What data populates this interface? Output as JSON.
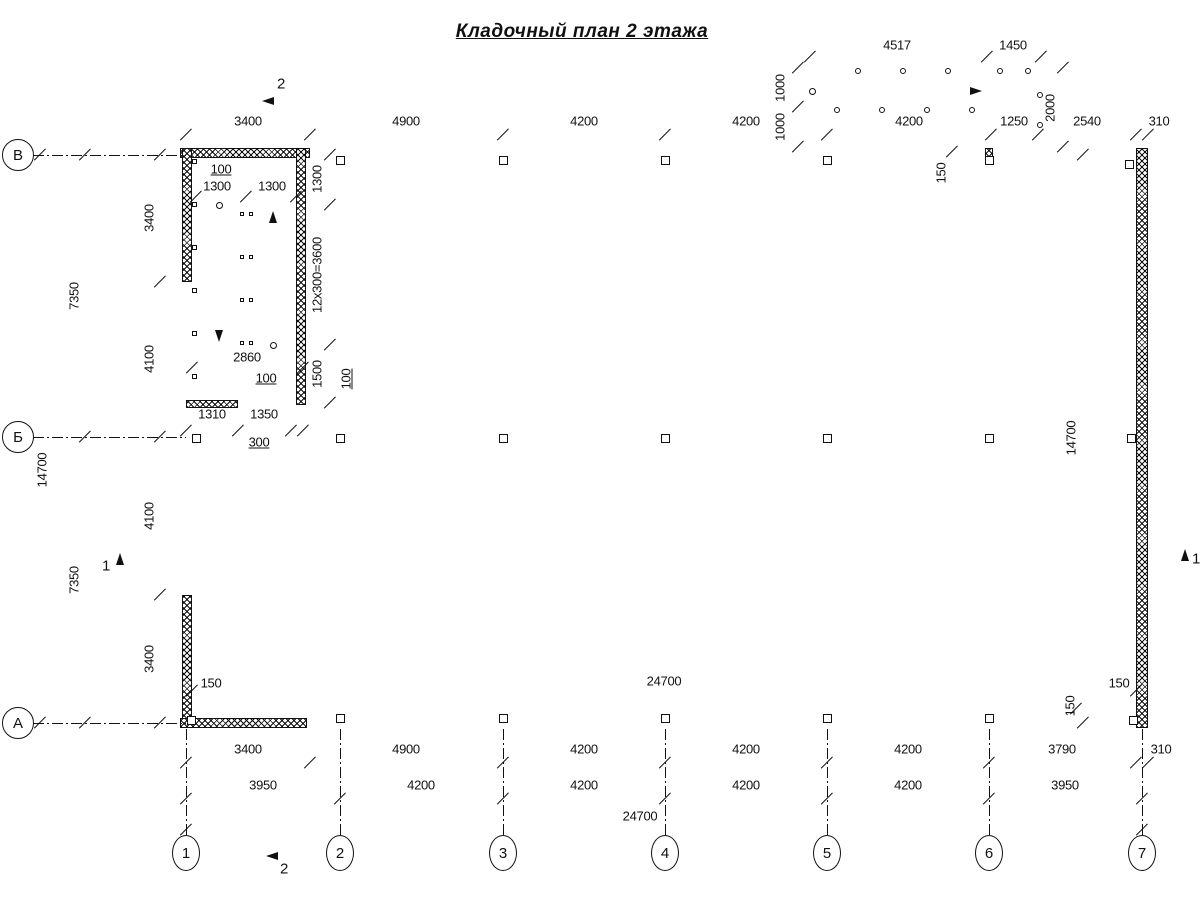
{
  "title": "Кладочный план 2 этажа",
  "drawing": {
    "axis_left": [
      {
        "t": "В",
        "x": 18,
        "y": 155
      },
      {
        "t": "Б",
        "x": 18,
        "y": 437
      },
      {
        "t": "А",
        "x": 18,
        "y": 723
      }
    ],
    "axis_bottom": [
      {
        "t": "1",
        "x": 186,
        "y": 853
      },
      {
        "t": "2",
        "x": 340,
        "y": 853
      },
      {
        "t": "3",
        "x": 503,
        "y": 853
      },
      {
        "t": "4",
        "x": 665,
        "y": 853
      },
      {
        "t": "5",
        "x": 827,
        "y": 853
      },
      {
        "t": "6",
        "x": 989,
        "y": 853
      },
      {
        "t": "7",
        "x": 1142,
        "y": 853
      }
    ],
    "section_labels": [
      {
        "t": "2",
        "x": 281,
        "y": 84
      },
      {
        "t": "2",
        "x": 284,
        "y": 869
      },
      {
        "t": "1",
        "x": 106,
        "y": 566
      },
      {
        "t": "1",
        "x": 1196,
        "y": 559
      }
    ],
    "dim_labels": [
      {
        "t": "4517",
        "x": 897,
        "y": 45
      },
      {
        "t": "1450",
        "x": 1013,
        "y": 45
      },
      {
        "t": "1000",
        "x": 780,
        "y": 88,
        "r": 1
      },
      {
        "t": "1000",
        "x": 780,
        "y": 127,
        "r": 1
      },
      {
        "t": "2000",
        "x": 1050,
        "y": 108,
        "r": 1
      },
      {
        "t": "3400",
        "x": 248,
        "y": 121
      },
      {
        "t": "4900",
        "x": 406,
        "y": 121
      },
      {
        "t": "4200",
        "x": 584,
        "y": 121
      },
      {
        "t": "4200",
        "x": 746,
        "y": 121
      },
      {
        "t": "4200",
        "x": 909,
        "y": 121
      },
      {
        "t": "1250",
        "x": 1014,
        "y": 121
      },
      {
        "t": "2540",
        "x": 1087,
        "y": 121
      },
      {
        "t": "310",
        "x": 1159,
        "y": 121
      },
      {
        "t": "150",
        "x": 941,
        "y": 173,
        "r": 1
      },
      {
        "t": "3400",
        "x": 149,
        "y": 218,
        "r": 1
      },
      {
        "t": "4100",
        "x": 149,
        "y": 359,
        "r": 1
      },
      {
        "t": "4100",
        "x": 149,
        "y": 516,
        "r": 1
      },
      {
        "t": "3400",
        "x": 149,
        "y": 659,
        "r": 1
      },
      {
        "t": "7350",
        "x": 74,
        "y": 296,
        "r": 1
      },
      {
        "t": "7350",
        "x": 74,
        "y": 580,
        "r": 1
      },
      {
        "t": "14700",
        "x": 42,
        "y": 470,
        "r": 1
      },
      {
        "t": "100",
        "x": 221,
        "y": 169,
        "u": 1
      },
      {
        "t": "1300",
        "x": 217,
        "y": 186
      },
      {
        "t": "1300",
        "x": 272,
        "y": 186
      },
      {
        "t": "1300",
        "x": 317,
        "y": 179,
        "r": 1
      },
      {
        "t": "12x300=3600",
        "x": 317,
        "y": 275,
        "r": 1
      },
      {
        "t": "1500",
        "x": 317,
        "y": 374,
        "r": 1
      },
      {
        "t": "100",
        "x": 346,
        "y": 379,
        "r": 1,
        "u": 1
      },
      {
        "t": "2860",
        "x": 247,
        "y": 357
      },
      {
        "t": "100",
        "x": 266,
        "y": 378,
        "u": 1
      },
      {
        "t": "1310",
        "x": 212,
        "y": 414
      },
      {
        "t": "1350",
        "x": 264,
        "y": 414
      },
      {
        "t": "300",
        "x": 259,
        "y": 442,
        "u": 1
      },
      {
        "t": "24700",
        "x": 664,
        "y": 681
      },
      {
        "t": "150",
        "x": 211,
        "y": 683
      },
      {
        "t": "150",
        "x": 1119,
        "y": 683
      },
      {
        "t": "150",
        "x": 1070,
        "y": 706,
        "r": 1
      },
      {
        "t": "14700",
        "x": 1071,
        "y": 438,
        "r": 1
      },
      {
        "t": "3400",
        "x": 248,
        "y": 749
      },
      {
        "t": "4900",
        "x": 406,
        "y": 749
      },
      {
        "t": "4200",
        "x": 584,
        "y": 749
      },
      {
        "t": "4200",
        "x": 746,
        "y": 749
      },
      {
        "t": "4200",
        "x": 908,
        "y": 749
      },
      {
        "t": "3790",
        "x": 1062,
        "y": 749
      },
      {
        "t": "310",
        "x": 1161,
        "y": 749
      },
      {
        "t": "3950",
        "x": 263,
        "y": 785
      },
      {
        "t": "4200",
        "x": 421,
        "y": 785
      },
      {
        "t": "4200",
        "x": 584,
        "y": 785
      },
      {
        "t": "4200",
        "x": 746,
        "y": 785
      },
      {
        "t": "4200",
        "x": 908,
        "y": 785
      },
      {
        "t": "3950",
        "x": 1065,
        "y": 785
      },
      {
        "t": "24700",
        "x": 640,
        "y": 816
      }
    ],
    "walls": [
      {
        "x": 180,
        "y": 148,
        "w": 130,
        "h": 10
      },
      {
        "x": 182,
        "y": 148,
        "w": 10,
        "h": 134
      },
      {
        "x": 182,
        "y": 595,
        "w": 10,
        "h": 133
      },
      {
        "x": 180,
        "y": 718,
        "w": 127,
        "h": 10
      },
      {
        "x": 1136,
        "y": 148,
        "w": 12,
        "h": 580
      },
      {
        "x": 296,
        "y": 148,
        "w": 10,
        "h": 257
      },
      {
        "x": 186,
        "y": 400,
        "w": 52,
        "h": 8
      },
      {
        "x": 985,
        "y": 148,
        "w": 8,
        "h": 13
      }
    ],
    "lines": [
      {
        "x": 800,
        "y": 57,
        "l": 250,
        "o": "h"
      },
      {
        "x": 798,
        "y": 62,
        "l": 92,
        "o": "v"
      },
      {
        "x": 1063,
        "y": 62,
        "l": 92,
        "o": "v"
      },
      {
        "x": 178,
        "y": 135,
        "l": 982,
        "o": "h"
      },
      {
        "x": 160,
        "y": 146,
        "l": 584,
        "o": "v"
      },
      {
        "x": 85,
        "y": 146,
        "l": 584,
        "o": "v"
      },
      {
        "x": 40,
        "y": 146,
        "l": 584,
        "o": "v"
      },
      {
        "x": 186,
        "y": 691,
        "l": 956,
        "o": "h"
      },
      {
        "x": 1083,
        "y": 152,
        "l": 571,
        "o": "v"
      },
      {
        "x": 178,
        "y": 763,
        "l": 982,
        "o": "h"
      },
      {
        "x": 178,
        "y": 799,
        "l": 976,
        "o": "h"
      },
      {
        "x": 178,
        "y": 830,
        "l": 976,
        "o": "h"
      },
      {
        "x": 192,
        "y": 197,
        "l": 110,
        "o": "h"
      },
      {
        "x": 330,
        "y": 150,
        "l": 260,
        "o": "v"
      },
      {
        "x": 188,
        "y": 368,
        "l": 119,
        "o": "h"
      },
      {
        "x": 180,
        "y": 431,
        "l": 128,
        "o": "h"
      },
      {
        "x": 310,
        "y": 148,
        "l": 683,
        "o": "h"
      },
      {
        "x": 310,
        "y": 152.5,
        "l": 683,
        "o": "h"
      },
      {
        "x": 310,
        "y": 157,
        "l": 683,
        "o": "h"
      },
      {
        "x": 1034,
        "y": 148,
        "l": 102,
        "o": "h"
      },
      {
        "x": 1034,
        "y": 152.5,
        "l": 102,
        "o": "h"
      },
      {
        "x": 1034,
        "y": 157,
        "l": 102,
        "o": "h"
      },
      {
        "x": 307,
        "y": 718,
        "l": 829,
        "o": "h"
      },
      {
        "x": 307,
        "y": 722.5,
        "l": 829,
        "o": "h"
      },
      {
        "x": 307,
        "y": 727,
        "l": 829,
        "o": "h"
      },
      {
        "x": 183,
        "y": 282,
        "l": 313,
        "o": "v"
      },
      {
        "x": 187,
        "y": 282,
        "l": 313,
        "o": "v"
      },
      {
        "x": 191,
        "y": 282,
        "l": 313,
        "o": "v"
      },
      {
        "x": 196,
        "y": 205,
        "l": 47,
        "o": "h",
        "n": 13,
        "sy": 11.67
      },
      {
        "x": 249,
        "y": 205,
        "l": 47,
        "o": "h",
        "n": 13,
        "sy": 11.67
      },
      {
        "x": 243.5,
        "y": 203,
        "l": 144,
        "o": "v"
      },
      {
        "x": 249.5,
        "y": 203,
        "l": 144,
        "o": "v"
      },
      {
        "x": 219,
        "y": 207,
        "l": 133,
        "o": "v"
      },
      {
        "x": 273,
        "y": 212,
        "l": 131,
        "o": "v"
      },
      {
        "x": 810,
        "y": 71,
        "l": 230,
        "o": "h"
      },
      {
        "x": 810,
        "y": 75,
        "l": 177,
        "o": "h"
      },
      {
        "x": 810,
        "y": 110,
        "l": 177,
        "o": "h"
      },
      {
        "x": 810,
        "y": 106,
        "l": 177,
        "o": "h"
      },
      {
        "x": 816,
        "y": 71,
        "l": 39,
        "o": "v",
        "n": 15,
        "sx": 12
      },
      {
        "x": 810,
        "y": 71,
        "l": 39,
        "o": "v"
      },
      {
        "x": 987,
        "y": 71,
        "l": 77,
        "o": "v"
      },
      {
        "x": 1040,
        "y": 71,
        "l": 77,
        "o": "v"
      },
      {
        "x": 816,
        "y": 91,
        "l": 163,
        "o": "h"
      },
      {
        "x": 1034,
        "y": 148,
        "l": 10,
        "o": "v"
      },
      {
        "x": 310,
        "y": 137,
        "l": 12,
        "o": "v"
      },
      {
        "x": 1038,
        "y": 137,
        "l": 12,
        "o": "v"
      },
      {
        "x": 310,
        "y": 729,
        "l": 34,
        "o": "v"
      },
      {
        "x": 160,
        "y": 282,
        "l": 24,
        "o": "h"
      },
      {
        "x": 160,
        "y": 595,
        "l": 24,
        "o": "h"
      },
      {
        "x": 306,
        "y": 205,
        "l": 30,
        "o": "h"
      },
      {
        "x": 306,
        "y": 345,
        "l": 30,
        "o": "h"
      },
      {
        "x": 306,
        "y": 403,
        "l": 30,
        "o": "h"
      },
      {
        "x": 238,
        "y": 408,
        "l": 26,
        "o": "v"
      },
      {
        "x": 291,
        "y": 406,
        "l": 28,
        "o": "v"
      },
      {
        "x": 303,
        "y": 406,
        "l": 28,
        "o": "v"
      },
      {
        "x": 262,
        "y": 101,
        "l": 30,
        "o": "h"
      },
      {
        "x": 267,
        "y": 91,
        "l": 20,
        "o": "v"
      },
      {
        "x": 266,
        "y": 856,
        "l": 30,
        "o": "h"
      },
      {
        "x": 271,
        "y": 846,
        "l": 20,
        "o": "v"
      },
      {
        "x": 120,
        "y": 553,
        "l": 24,
        "o": "v"
      },
      {
        "x": 112,
        "y": 550,
        "l": 17,
        "o": "h"
      },
      {
        "x": 1185,
        "y": 549,
        "l": 29,
        "o": "v"
      },
      {
        "x": 1176,
        "y": 546,
        "l": 18,
        "o": "h"
      },
      {
        "x": 233,
        "y": 176,
        "l": 26,
        "o": "h",
        "a": 44
      },
      {
        "x": 281,
        "y": 380,
        "l": 24,
        "o": "h",
        "a": -27
      },
      {
        "x": 279,
        "y": 440,
        "l": 26,
        "o": "h",
        "a": -20
      },
      {
        "x": 309,
        "y": 404,
        "l": 36,
        "o": "h",
        "a": -21
      },
      {
        "x": 943,
        "y": 162,
        "l": 20,
        "o": "h",
        "a": -50
      }
    ],
    "dash_lines": [
      {
        "x": 33,
        "y": 155,
        "l": 153,
        "o": "h"
      },
      {
        "x": 33,
        "y": 437,
        "l": 153,
        "o": "h"
      },
      {
        "x": 33,
        "y": 723,
        "l": 153,
        "o": "h"
      },
      {
        "x": 186,
        "y": 729,
        "l": 108,
        "o": "v"
      },
      {
        "x": 340,
        "y": 729,
        "l": 108,
        "o": "v"
      },
      {
        "x": 503,
        "y": 729,
        "l": 108,
        "o": "v"
      },
      {
        "x": 665,
        "y": 729,
        "l": 108,
        "o": "v"
      },
      {
        "x": 827,
        "y": 729,
        "l": 108,
        "o": "v"
      },
      {
        "x": 989,
        "y": 729,
        "l": 108,
        "o": "v"
      },
      {
        "x": 1142,
        "y": 729,
        "l": 108,
        "o": "v"
      }
    ],
    "ticks": [
      [
        810,
        57
      ],
      [
        987,
        57
      ],
      [
        1041,
        57
      ],
      [
        798,
        68
      ],
      [
        798,
        107
      ],
      [
        798,
        147
      ],
      [
        1063,
        68
      ],
      [
        1063,
        147
      ],
      [
        186,
        135
      ],
      [
        310,
        135
      ],
      [
        503,
        135
      ],
      [
        665,
        135
      ],
      [
        827,
        135
      ],
      [
        991,
        135
      ],
      [
        1038,
        135
      ],
      [
        1136,
        135
      ],
      [
        1148,
        135
      ],
      [
        952,
        152
      ],
      [
        160,
        155
      ],
      [
        160,
        282
      ],
      [
        160,
        437
      ],
      [
        160,
        595
      ],
      [
        160,
        723
      ],
      [
        85,
        155
      ],
      [
        85,
        437
      ],
      [
        85,
        723
      ],
      [
        40,
        155
      ],
      [
        40,
        723
      ],
      [
        196,
        197
      ],
      [
        246,
        197
      ],
      [
        296,
        197
      ],
      [
        330,
        155
      ],
      [
        330,
        205
      ],
      [
        330,
        345
      ],
      [
        330,
        403
      ],
      [
        192,
        368
      ],
      [
        303,
        368
      ],
      [
        186,
        431
      ],
      [
        238,
        431
      ],
      [
        291,
        431
      ],
      [
        303,
        431
      ],
      [
        192,
        691
      ],
      [
        1136,
        691
      ],
      [
        1083,
        155
      ],
      [
        1083,
        723
      ],
      [
        1076,
        709
      ],
      [
        186,
        763
      ],
      [
        310,
        763
      ],
      [
        503,
        763
      ],
      [
        665,
        763
      ],
      [
        827,
        763
      ],
      [
        989,
        763
      ],
      [
        1136,
        763
      ],
      [
        1148,
        763
      ],
      [
        186,
        799
      ],
      [
        340,
        799
      ],
      [
        503,
        799
      ],
      [
        665,
        799
      ],
      [
        827,
        799
      ],
      [
        989,
        799
      ],
      [
        1142,
        799
      ],
      [
        186,
        830
      ],
      [
        1142,
        830
      ]
    ],
    "squares": [
      [
        340,
        160,
        9
      ],
      [
        503,
        160,
        9
      ],
      [
        665,
        160,
        9
      ],
      [
        827,
        160,
        9
      ],
      [
        989,
        160,
        9
      ],
      [
        1129,
        164,
        9
      ],
      [
        196,
        438,
        9
      ],
      [
        340,
        438,
        9
      ],
      [
        503,
        438,
        9
      ],
      [
        665,
        438,
        9
      ],
      [
        827,
        438,
        9
      ],
      [
        989,
        438,
        9
      ],
      [
        1131,
        438,
        9
      ],
      [
        191,
        720,
        9
      ],
      [
        340,
        718,
        9
      ],
      [
        503,
        718,
        9
      ],
      [
        665,
        718,
        9
      ],
      [
        827,
        718,
        9
      ],
      [
        989,
        718,
        9
      ],
      [
        1133,
        720,
        9
      ],
      [
        194,
        161,
        5
      ],
      [
        194,
        204,
        5
      ],
      [
        194,
        247,
        5
      ],
      [
        194,
        290,
        5
      ],
      [
        194,
        333,
        5
      ],
      [
        194,
        376,
        5
      ],
      [
        242,
        214,
        4
      ],
      [
        251,
        214,
        4
      ],
      [
        242,
        257,
        4
      ],
      [
        251,
        257,
        4
      ],
      [
        242,
        300,
        4
      ],
      [
        251,
        300,
        4
      ],
      [
        242,
        343,
        4
      ],
      [
        251,
        343,
        4
      ]
    ],
    "circles": [
      [
        812,
        91,
        3.5
      ],
      [
        858,
        71,
        3
      ],
      [
        903,
        71,
        3
      ],
      [
        948,
        71,
        3
      ],
      [
        837,
        110,
        3
      ],
      [
        882,
        110,
        3
      ],
      [
        927,
        110,
        3
      ],
      [
        972,
        110,
        3
      ],
      [
        1000,
        71,
        3
      ],
      [
        1028,
        71,
        3
      ],
      [
        1040,
        95,
        3
      ],
      [
        1040,
        125,
        3
      ],
      [
        219,
        205,
        3.5
      ],
      [
        273,
        345,
        3.5
      ]
    ],
    "arrows": [
      [
        981,
        91,
        "r"
      ],
      [
        219,
        341,
        "d"
      ],
      [
        273,
        211,
        "u"
      ],
      [
        262,
        101,
        "l"
      ],
      [
        266,
        856,
        "l"
      ],
      [
        120,
        553,
        "u"
      ],
      [
        1185,
        549,
        "u"
      ]
    ]
  }
}
